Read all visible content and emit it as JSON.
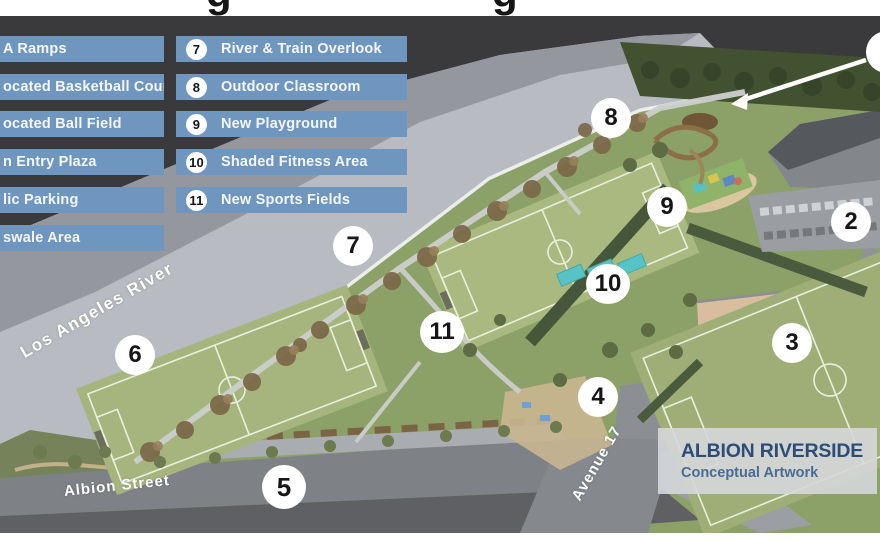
{
  "title_strip": {
    "glyphs": [
      "g",
      "g"
    ]
  },
  "legend": {
    "left_items": [
      "A Ramps",
      "ocated Basketball Courts",
      "ocated Ball Field",
      "n Entry Plaza",
      "lic Parking",
      "swale Area"
    ],
    "numbered_items": [
      {
        "number": "7",
        "label": "River & Train Overlook"
      },
      {
        "number": "8",
        "label": "Outdoor Classroom"
      },
      {
        "number": "9",
        "label": "New Playground"
      },
      {
        "number": "10",
        "label": "Shaded Fitness Area"
      },
      {
        "number": "11",
        "label": "New Sports Fields"
      }
    ]
  },
  "map": {
    "markers": [
      "2",
      "3",
      "4",
      "5",
      "6",
      "7",
      "8",
      "9",
      "10",
      "11"
    ],
    "street_labels": {
      "river": "Los Angeles River",
      "albion": "Albion Street",
      "ave17": "Avenue 17"
    },
    "credit": {
      "title": "ALBION RIVERSIDE",
      "subtitle": "Conceptual Artwork"
    }
  },
  "colors": {
    "background": "#3a3a3c",
    "legend_bar": "#6f96bf",
    "river_band": "#b8bbc1",
    "river_band_far": "#94979e",
    "park_green": "#8ca167",
    "field_green": "#a8b77e",
    "road_gray": "#7e8185",
    "diamond_tan": "#d9bd9f",
    "canopy_teal": "#58c3c7",
    "credit_title_blue": "#2b4d78"
  }
}
